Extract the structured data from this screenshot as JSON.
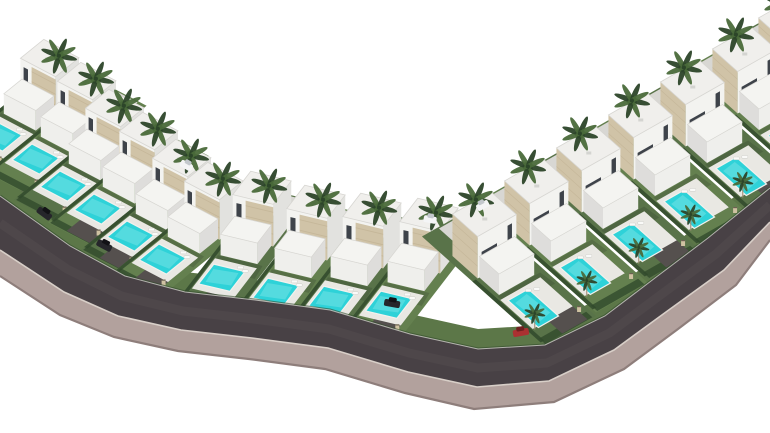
{
  "scene": {
    "label": "aerial-3d-render-villa-development-with-pools-curved-road",
    "width": 770,
    "height": 433,
    "palette": {
      "bg": "#ffffff",
      "lawn1": "#64804f",
      "lawn2": "#597349",
      "verge": "#5c7748",
      "hedge": "#314a2c",
      "pool": "#2ed2d8",
      "poolLight": "#8fe9ec",
      "poolCoping": "#f2f1ed",
      "deck": "#e9e8e3",
      "houseLit": "#f3f3f0",
      "houseSide": "#e2e2df",
      "lowLit": "#efefec",
      "lowSide": "#dedddb",
      "roof": "#f0efec",
      "roofEdge": "#d7d6d2",
      "stone": "#d0c3a7",
      "stoneDark": "#b9a88a",
      "window": "#3e434a",
      "palmDark": "#2c4529",
      "palmLight": "#4a6a3a",
      "trunk": "#a08d74",
      "asphalt": "#484145",
      "asphaltSheen": "#6a6266",
      "walk": "#b2a19d",
      "walkShade": "#8e7e7b",
      "curb": "#d8cfc8",
      "pad": "#55504e",
      "drive": "#d8d7d3",
      "backWall": "#dcdbd7",
      "carDark": "#26262b",
      "carRed": "#ab3131",
      "carWhite": "#f4f5f6",
      "pillar": "#cfc2a2",
      "pillarEdge": "#6b6152",
      "shadow": "rgba(48,58,44,0.25)",
      "ac": "#d4d4d1",
      "lounger": "#fafaf8"
    },
    "rows": [
      {
        "id": "left-steep",
        "u": [
          40,
          21
        ],
        "v": [
          -52,
          42
        ],
        "h": 40,
        "stone": "front",
        "houses": [
          [
            18,
            97
          ],
          [
            55,
            120
          ],
          [
            83,
            147
          ],
          [
            117,
            170
          ],
          [
            150,
            197
          ],
          [
            182,
            220
          ]
        ],
        "pads": [
          3,
          4,
          5
        ],
        "extraPalm": false
      },
      {
        "id": "left-flat",
        "u": [
          46,
          11
        ],
        "v": [
          -40,
          52
        ],
        "h": 42,
        "stone": "front",
        "houses": [
          [
            230,
            236
          ],
          [
            284,
            250
          ],
          [
            340,
            258
          ],
          [
            397,
            263
          ]
        ],
        "pads": [
          0,
          1,
          2,
          3
        ],
        "extraPalm": false
      },
      {
        "id": "right",
        "u": [
          44,
          -25
        ],
        "v": [
          56,
          50
        ],
        "h": 42,
        "stone": "end",
        "houses": [
          [
            475,
            280
          ],
          [
            527,
            247
          ],
          [
            579,
            214
          ],
          [
            631,
            181
          ],
          [
            683,
            148
          ],
          [
            735,
            115
          ],
          [
            781,
            84
          ]
        ],
        "pads": [
          0,
          2,
          4
        ],
        "extraPalm": true
      }
    ],
    "road": {
      "top": [
        [
          0,
          196
        ],
        [
          70,
          246
        ],
        [
          125,
          276
        ],
        [
          185,
          292
        ],
        [
          255,
          300
        ],
        [
          330,
          310
        ],
        [
          410,
          334
        ],
        [
          478,
          349
        ],
        [
          545,
          345
        ],
        [
          605,
          316
        ],
        [
          655,
          278
        ],
        [
          708,
          238
        ],
        [
          770,
          188
        ]
      ],
      "bottom": [
        [
          0,
          250
        ],
        [
          64,
          292
        ],
        [
          118,
          316
        ],
        [
          181,
          330
        ],
        [
          252,
          338
        ],
        [
          328,
          348
        ],
        [
          408,
          372
        ],
        [
          477,
          387
        ],
        [
          549,
          381
        ],
        [
          614,
          350
        ],
        [
          666,
          312
        ],
        [
          724,
          270
        ],
        [
          770,
          222
        ]
      ],
      "walkEdge": [
        [
          0,
          276
        ],
        [
          60,
          315
        ],
        [
          114,
          337
        ],
        [
          178,
          351
        ],
        [
          249,
          359
        ],
        [
          325,
          369
        ],
        [
          405,
          393
        ],
        [
          474,
          409
        ],
        [
          554,
          402
        ],
        [
          624,
          369
        ],
        [
          678,
          329
        ],
        [
          736,
          285
        ],
        [
          770,
          240
        ]
      ],
      "vergeRise": 20
    },
    "wedge": [
      [
        0,
        148
      ],
      [
        22,
        160
      ],
      [
        26,
        206
      ],
      [
        0,
        230
      ]
    ],
    "carsRoad": [
      {
        "x": 44,
        "y": 214,
        "a": 36,
        "c": "dark"
      },
      {
        "x": 104,
        "y": 246,
        "a": 28,
        "c": "dark"
      },
      {
        "x": 392,
        "y": 304,
        "a": 10,
        "c": "dark"
      },
      {
        "x": 521,
        "y": 333,
        "a": -10,
        "c": "red"
      }
    ],
    "carsDrive": [
      {
        "x": 186,
        "y": 166,
        "a": 30,
        "c": "white"
      },
      {
        "x": 430,
        "y": 220,
        "a": 10,
        "c": "white"
      },
      {
        "x": 483,
        "y": 206,
        "a": -28,
        "c": "white"
      }
    ],
    "villa_count": 17
  }
}
